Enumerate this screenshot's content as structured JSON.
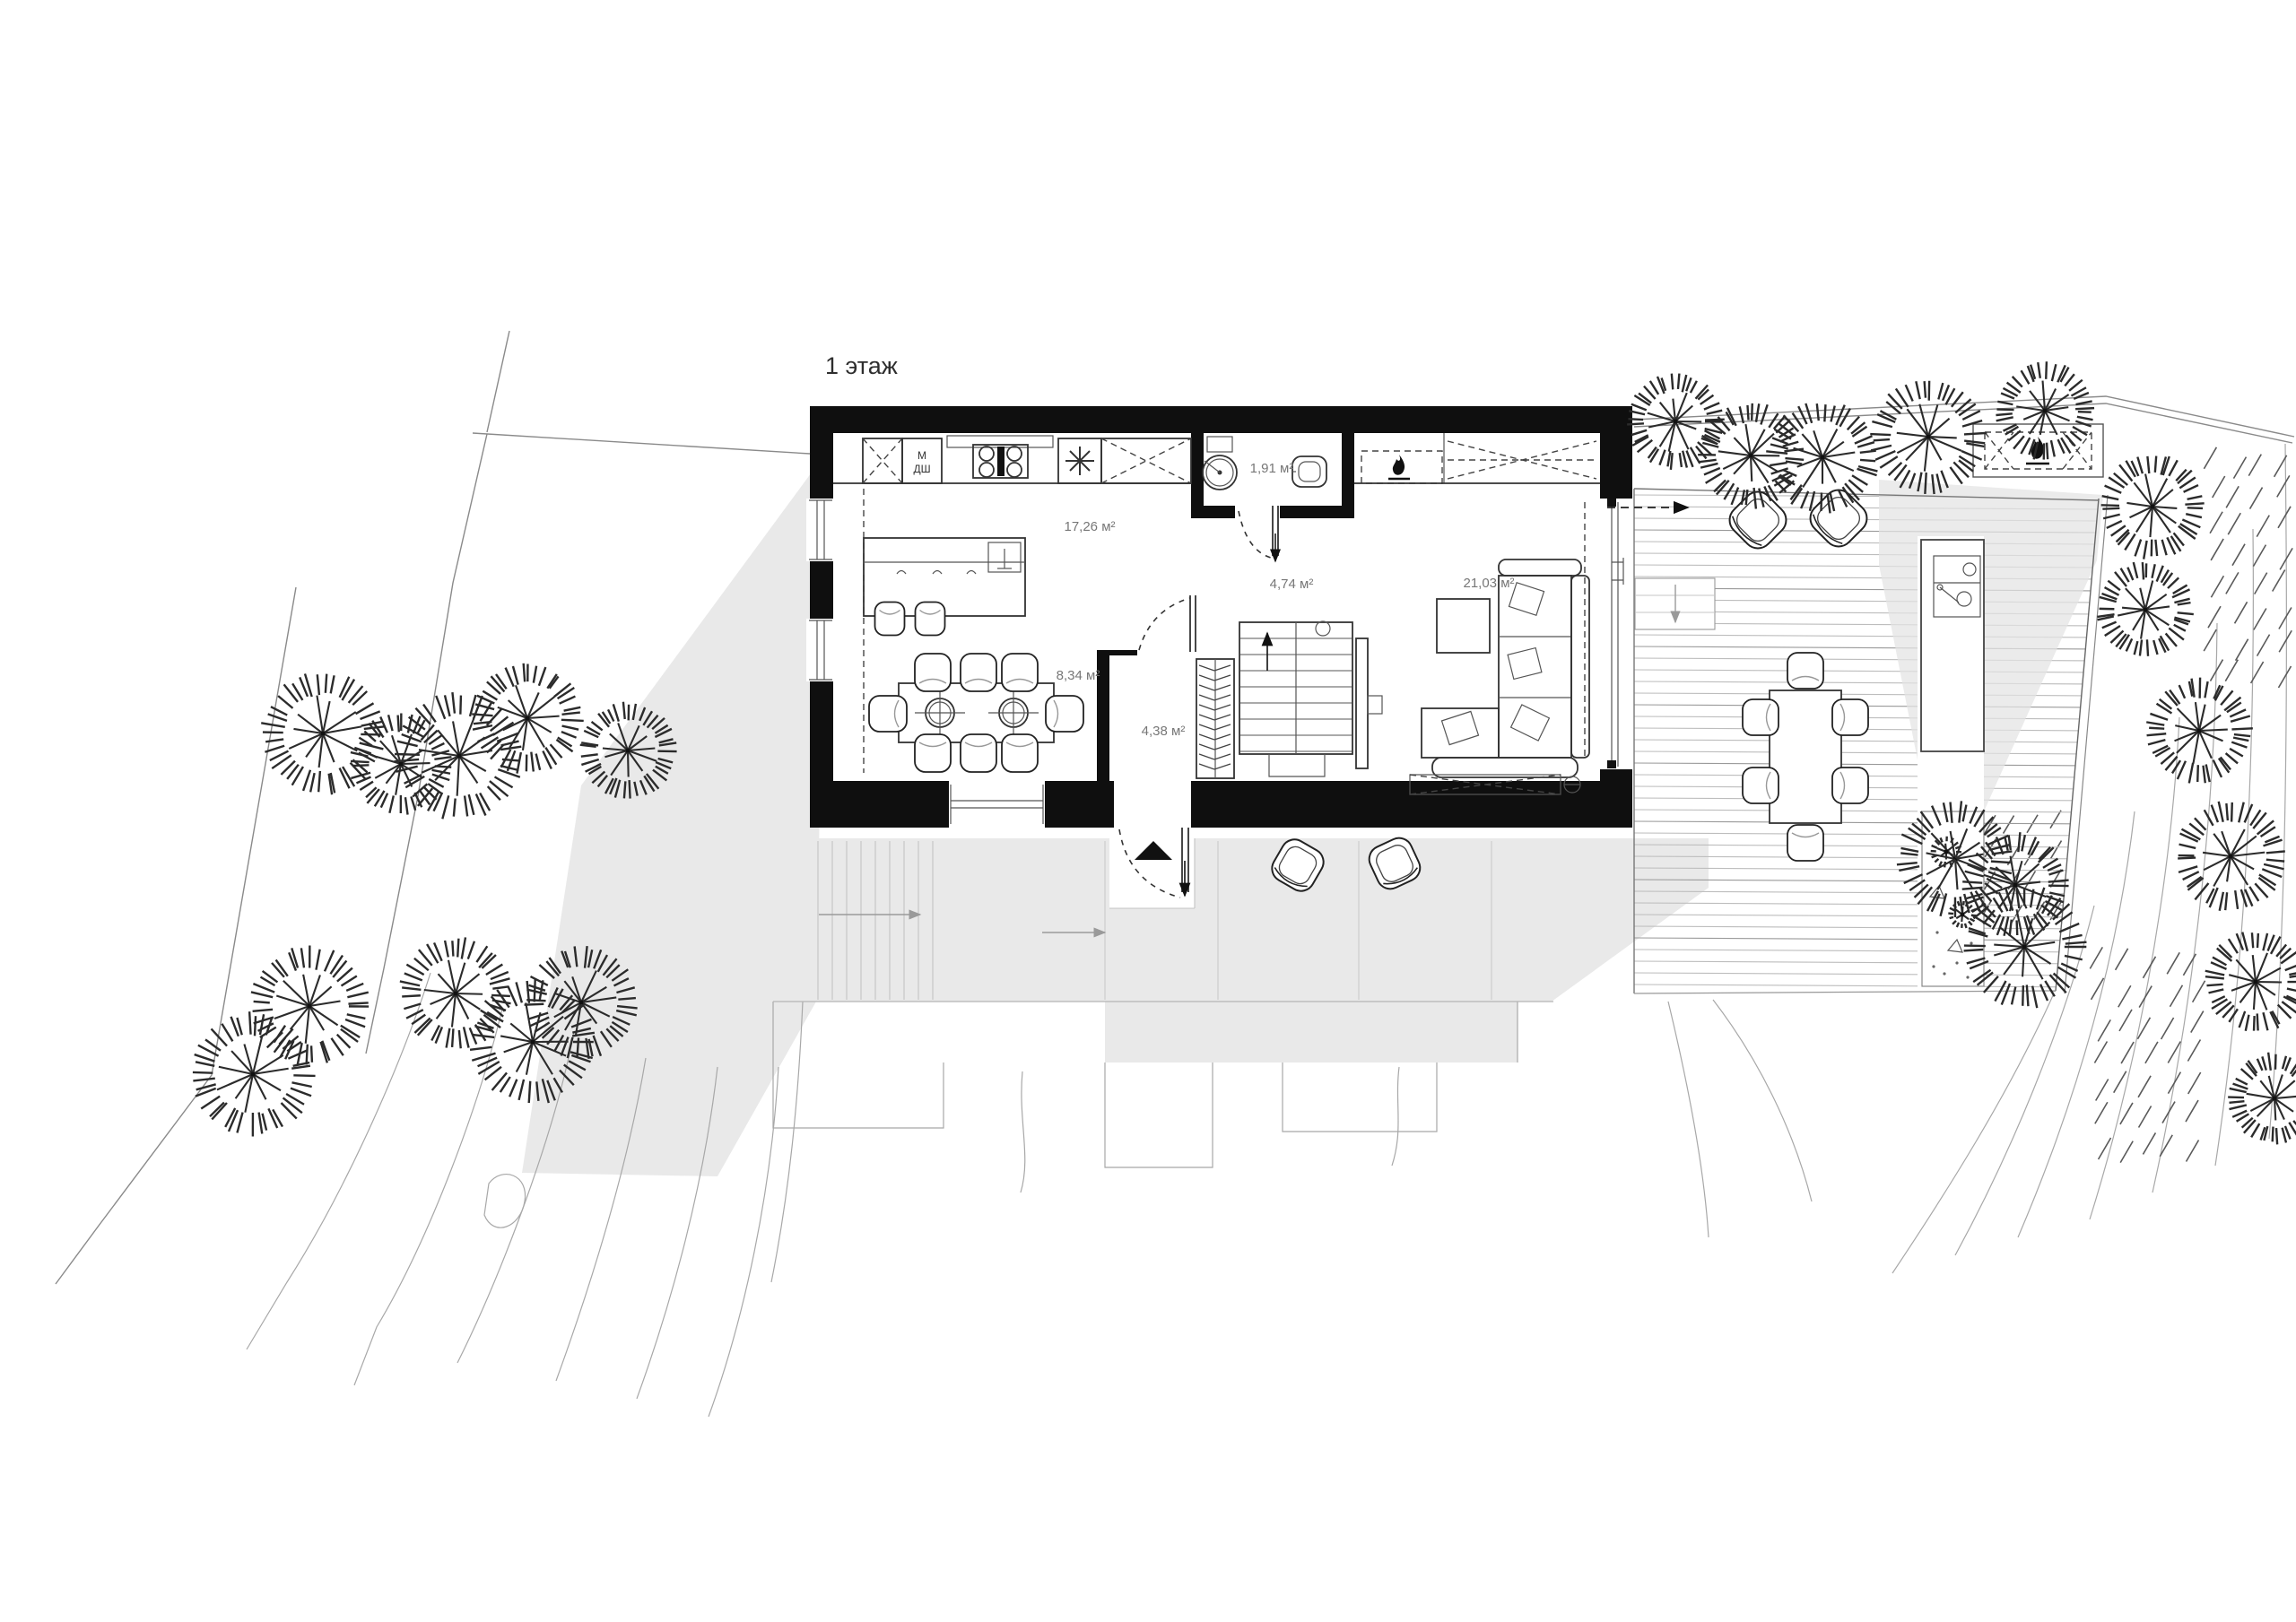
{
  "title": "1 этаж",
  "rooms": {
    "kitchen": "17,26 м²",
    "bathroom": "1,91 м²",
    "hall": "4,74 м²",
    "living": "21,03 м²",
    "dining": "8,34 м²",
    "entry": "4,38 м²"
  },
  "appliances": {
    "washer": "М",
    "dishwasher": "ДШ"
  },
  "icons": {
    "fireplace": "flame-icon",
    "barbecue": "flame-icon",
    "freezer": "snowflake-icon",
    "entrance_marker": "triangle-up-icon",
    "stairs_direction": "arrow-up-icon",
    "exit_direction": "arrow-icon"
  },
  "colors": {
    "wall": "#0f0f0f",
    "line": "#333333",
    "shadow": "#e9e9e9",
    "deck": "#b5b5b5",
    "contour": "#a8a8a8",
    "label": "#777777"
  }
}
